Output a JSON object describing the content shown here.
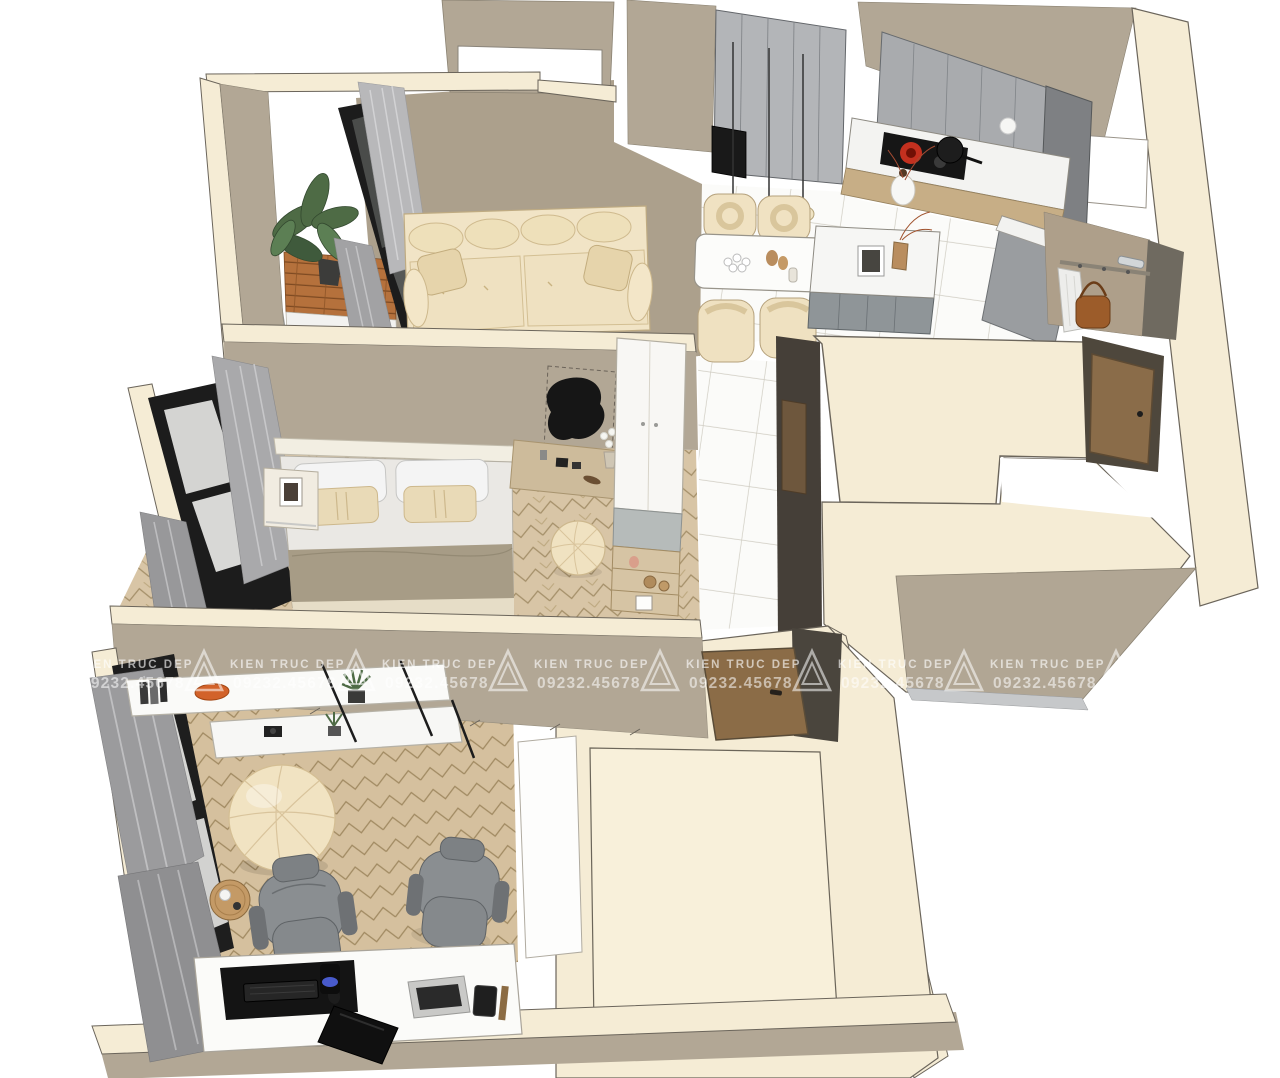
{
  "document": {
    "type": "3d-apartment-floor-plan-render",
    "view": "isometric cutaway from above",
    "background": "#ffffff"
  },
  "watermark": {
    "brand": "KIEN TRUC DEP",
    "phone": "09232.45678",
    "logo": "triangle-outline-logo",
    "repeat": 9,
    "spacing_px": 152,
    "start_x": 33,
    "row_y": 648,
    "color": "#ffffff",
    "opacity": 0.55
  },
  "palette": {
    "wall_cream": "#f5ecd5",
    "wall_taupe": "#b2a795",
    "wall_dark_taupe": "#453f38",
    "living_floor": "#aca08c",
    "tile_white": "#fbfbf9",
    "tile_grout": "#cfccc2",
    "herringbone_wood": "#d8c5a6",
    "deck_wood": "#b5713c",
    "cabinet_gray": "#a9abae",
    "counter_white": "#f3f3f1",
    "counter_base_wood": "#c7ae86",
    "sofa_cream": "#f1e4c6",
    "curtain_gray": "#9a9a9c",
    "frame_black": "#1c1c1c",
    "door_wood": "#8a6c49",
    "burner_red": "#c3301f",
    "plant_green": "#4e6b45",
    "bag_brown": "#9c5c2a",
    "office_chair_gray": "#898d90",
    "glass_gray": "#d6d6d4"
  },
  "rooms": [
    {
      "id": "living-room",
      "furniture": [
        "cream-tufted-sofa",
        "potted-plant",
        "balcony-wood-deck",
        "glass-balcony-door",
        "gray-curtains"
      ]
    },
    {
      "id": "kitchen-dining",
      "furniture": [
        "tall-gray-cabinets",
        "l-shaped-counter",
        "induction-cooktop",
        "black-pot",
        "kitchen-island",
        "dining-table",
        "four-cream-chairs",
        "three-pendant-lamps",
        "white-vase"
      ]
    },
    {
      "id": "entry",
      "furniture": [
        "coat-rack",
        "hanging-garment",
        "brown-bag",
        "entrance-door",
        "chrome-handle"
      ]
    },
    {
      "id": "bathroom-covered",
      "furniture": [
        "cream-roof-slab"
      ]
    },
    {
      "id": "bedroom",
      "furniture": [
        "double-bed",
        "nightstand",
        "black-organic-mirror",
        "vanity-desk",
        "white-wardrobe",
        "wood-shelves",
        "round-pouf",
        "black-frame-window",
        "gray-curtains"
      ]
    },
    {
      "id": "office",
      "furniture": [
        "floating-shelves",
        "bean-bag",
        "side-table",
        "two-office-chairs",
        "computer-desk",
        "monitor",
        "keyboard",
        "laptop",
        "black-frame-window",
        "gray-curtains"
      ]
    },
    {
      "id": "storage-room-covered",
      "furniture": [
        "cream-roof-slab",
        "wood-door"
      ]
    }
  ]
}
